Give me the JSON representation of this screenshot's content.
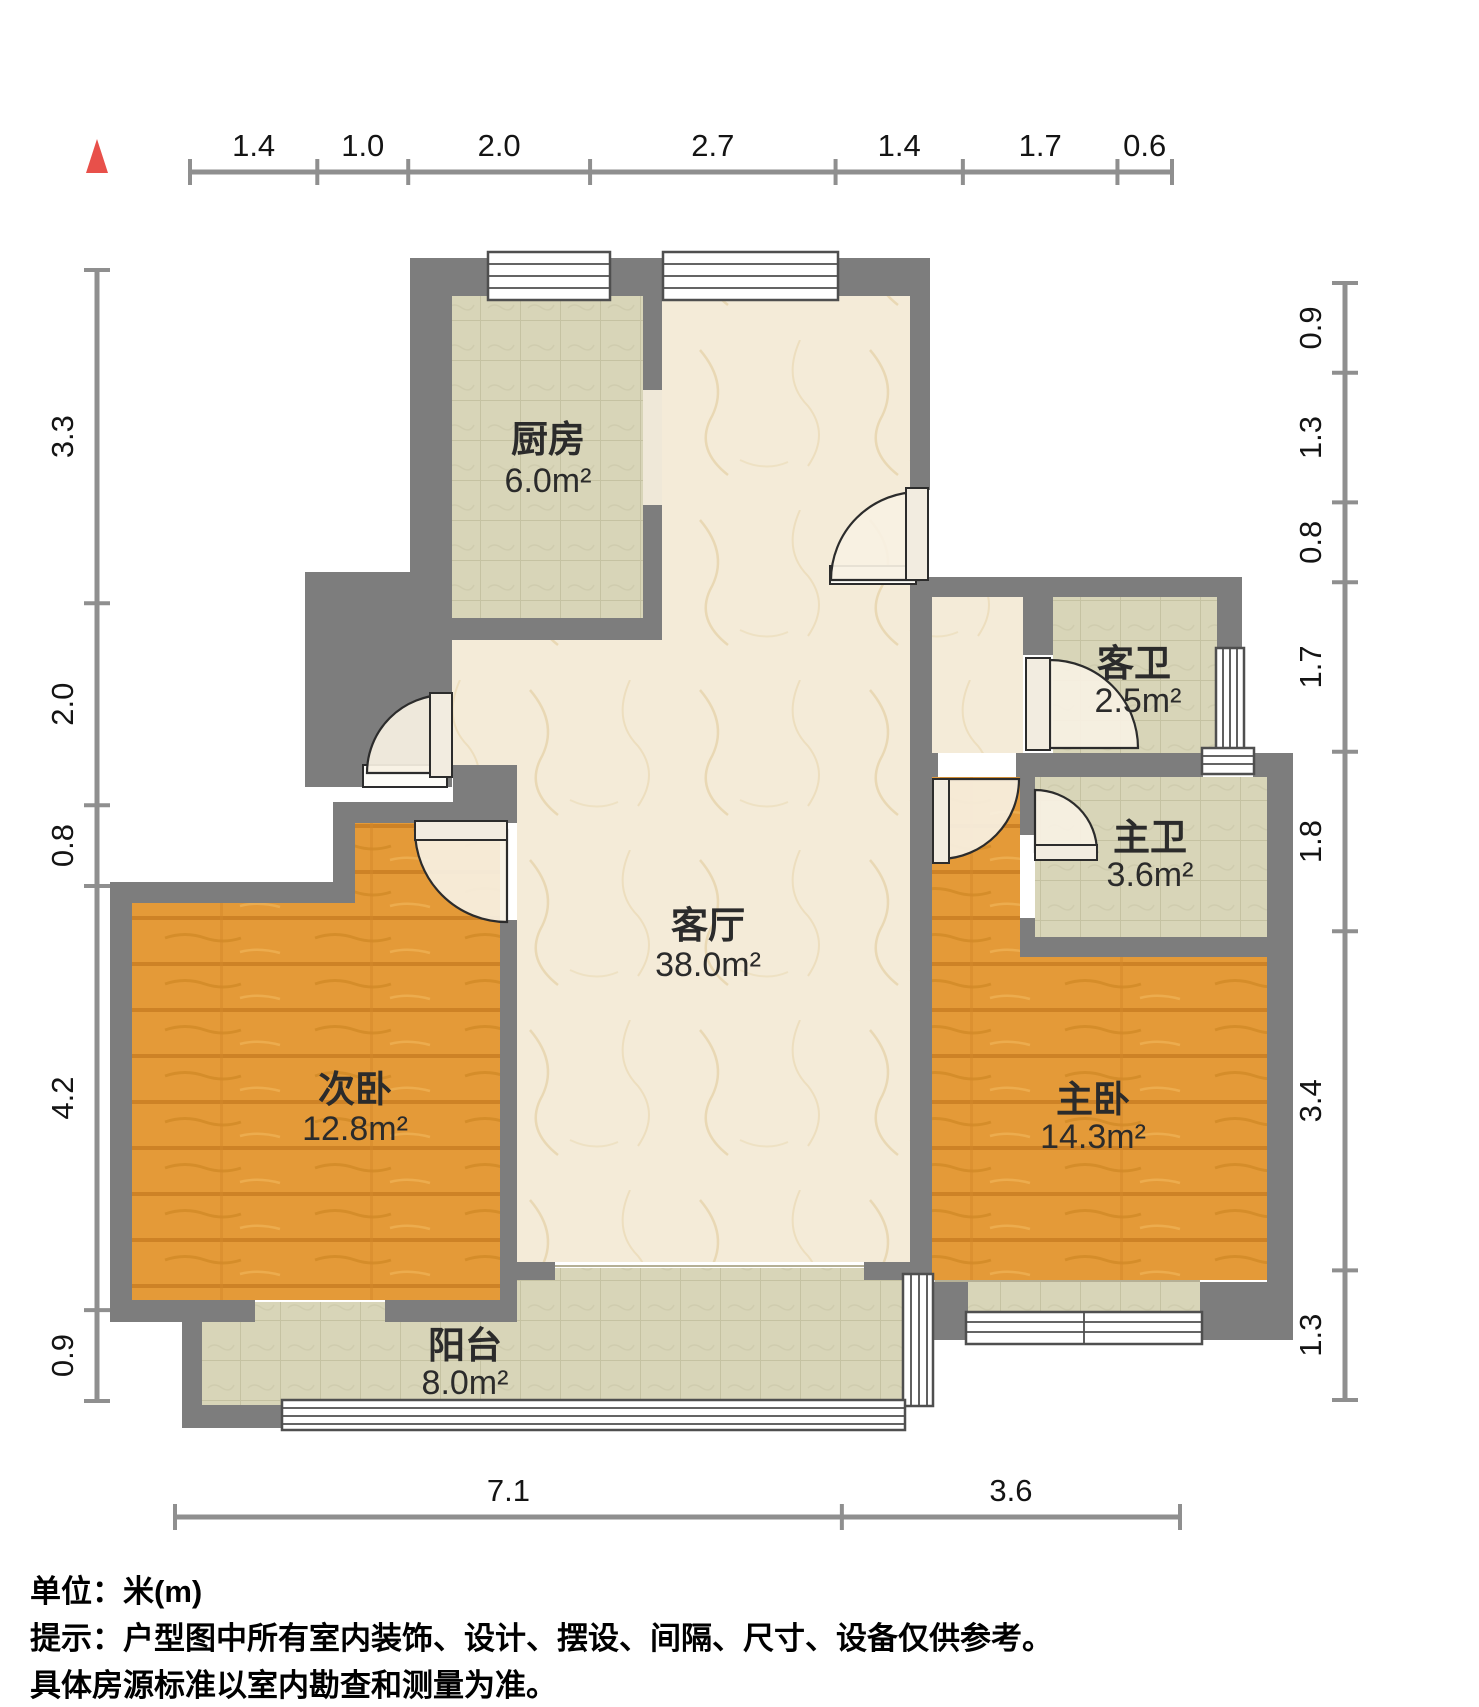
{
  "plan": {
    "title_hint": "户型图",
    "north_marker": "red-triangle",
    "colors": {
      "wall": "#7d7d7d",
      "wood_floor": "#e49a38",
      "tile_floor": "#d8d5b8",
      "marble_floor": "#f4ebd8",
      "north_marker": "#e8504a"
    }
  },
  "rooms": {
    "kitchen": {
      "name": "厨房",
      "area": "6.0m²"
    },
    "living": {
      "name": "客厅",
      "area": "38.0m²"
    },
    "guest_bath": {
      "name": "客卫",
      "area": "2.5m²"
    },
    "master_bath": {
      "name": "主卫",
      "area": "3.6m²"
    },
    "second_bedroom": {
      "name": "次卧",
      "area": "12.8m²"
    },
    "master_bedroom": {
      "name": "主卧",
      "area": "14.3m²"
    },
    "balcony": {
      "name": "阳台",
      "area": "8.0m²"
    }
  },
  "dimensions": {
    "top": {
      "values": [
        "1.4",
        "1.0",
        "2.0",
        "2.7",
        "1.4",
        "1.7",
        "0.6"
      ]
    },
    "left": {
      "values": [
        "3.3",
        "2.0",
        "0.8",
        "4.2",
        "0.9"
      ]
    },
    "right": {
      "values": [
        "0.9",
        "1.3",
        "0.8",
        "1.7",
        "1.8",
        "3.4",
        "1.3"
      ]
    },
    "bottom": {
      "values": [
        "7.1",
        "3.6"
      ]
    }
  },
  "footer": {
    "line1": "单位：米(m)",
    "line2": "提示：户型图中所有室内装饰、设计、摆设、间隔、尺寸、设备仅供参考。",
    "line3": "具体房源标准以室内勘查和测量为准。"
  }
}
